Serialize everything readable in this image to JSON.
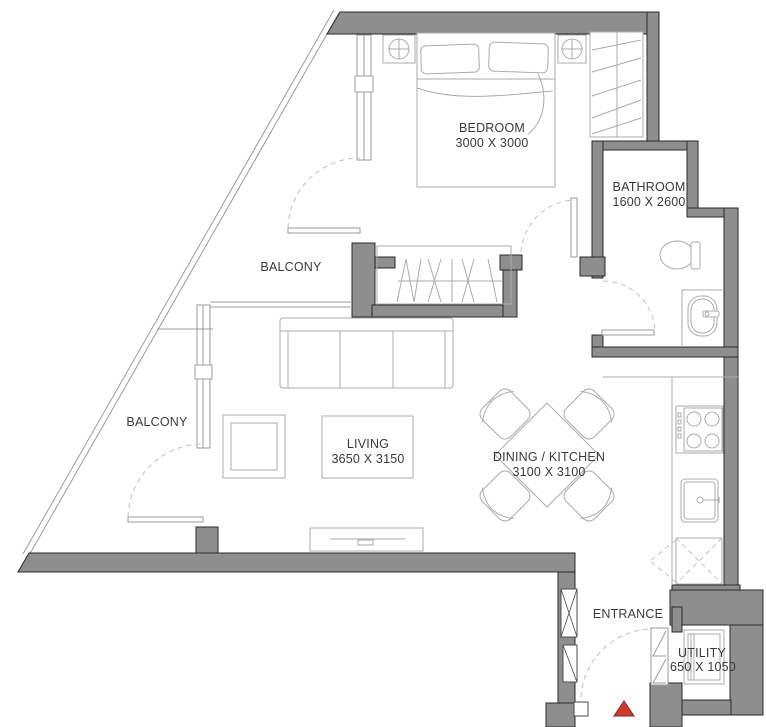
{
  "plan": {
    "type": "apartment-floor-plan",
    "rooms": [
      {
        "name": "BEDROOM",
        "dims": "3000 X 3000"
      },
      {
        "name": "BATHROOM",
        "dims": "1600 X 2600"
      },
      {
        "name": "BALCONY",
        "dims": ""
      },
      {
        "name": "BALCONY",
        "dims": ""
      },
      {
        "name": "LIVING",
        "dims": "3650 X 3150"
      },
      {
        "name": "DINING / KITCHEN",
        "dims": "3100 X 3100"
      },
      {
        "name": "ENTRANCE",
        "dims": ""
      },
      {
        "name": "UTILITY",
        "dims": "650 X 1050"
      }
    ],
    "colors": {
      "wall": "#8e8e8e",
      "outline": "#2a2a2a",
      "furniture": "#ababab",
      "door_arc": "#c2c2c2",
      "text": "#3a3a3a",
      "entry_marker": "#cf3a2e",
      "entry_marker_border": "#8c2420",
      "background": "#ffffff"
    }
  }
}
